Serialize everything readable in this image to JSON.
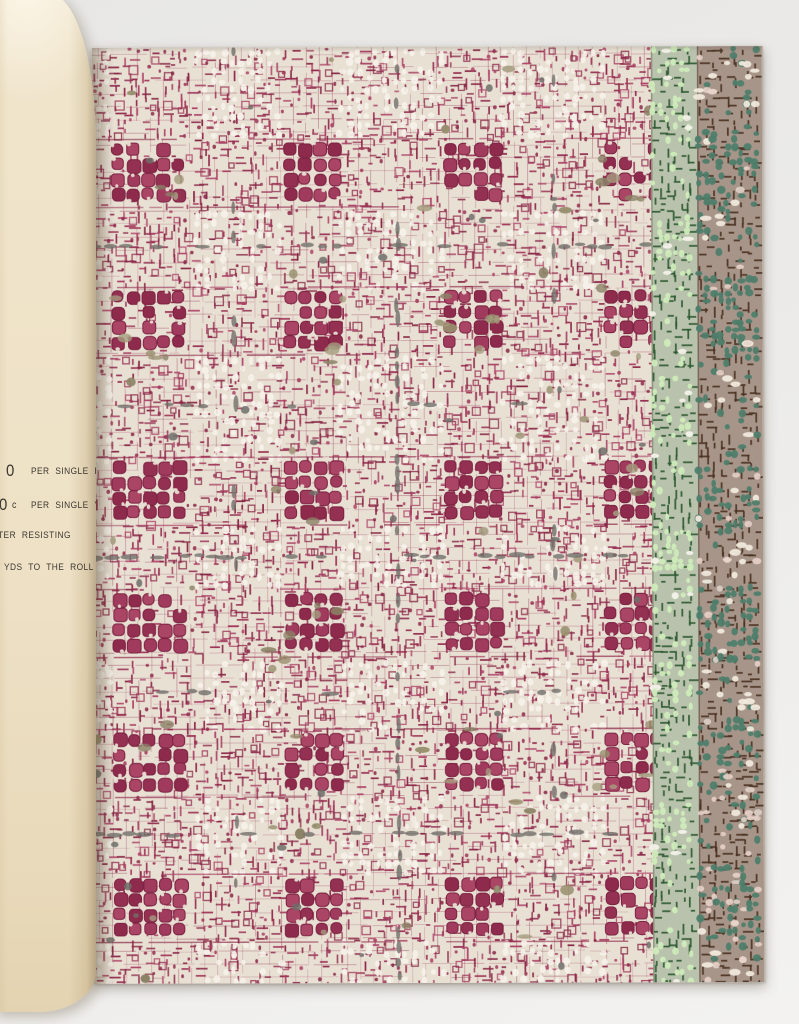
{
  "page_text": {
    "roll_price": "0",
    "roll_label": "PER SINGLE ROLL",
    "yard_price": "0",
    "yard_unit": "c",
    "yard_label": "PER SINGLE YARD",
    "feature_label": "TER RESISTING",
    "length_label": "YDS TO THE ROLL"
  },
  "pattern": {
    "seed": 7,
    "ground": "#e8e0d3",
    "white": "#f6f3ea",
    "maroon_shades": [
      "#93294d",
      "#a03558",
      "#872543",
      "#ad4166",
      "#8e2a4c"
    ],
    "block_shades": [
      "#a13b5e",
      "#943052",
      "#ab4566",
      "#8e2a4c"
    ],
    "block_stroke": "#7c2242",
    "olive_shades": [
      "#98906f",
      "#8b8266",
      "#a59d80"
    ],
    "gray": "#716f6a",
    "dark_gray_blob": "#6f6d68",
    "dense_cols": [
      {
        "c": 57,
        "hw": 40
      },
      {
        "c": 217,
        "hw": 28
      },
      {
        "c": 377,
        "hw": 28
      },
      {
        "c": 537,
        "hw": 28
      }
    ],
    "dense_row_centers": [
      125,
      273,
      443,
      575,
      715,
      860
    ],
    "row_halfwidth": 32,
    "gray_vertical": {
      "strong": [
        305
      ],
      "weak": [
        142,
        461
      ]
    },
    "gray_horizontal": {
      "strong": [
        199,
        509,
        787
      ],
      "medium": [
        358
      ],
      "weak": [
        645
      ]
    },
    "green_stripe": {
      "x": 559,
      "width": 46,
      "bg": "#b9c2ac",
      "dark": "#2e5a32",
      "mint": "#cfecba",
      "white": "#f3f1e9",
      "edge": "#5c6b50"
    },
    "taupe_stripe": {
      "x": 605,
      "width": 65,
      "bg": "#a8958a",
      "dark": "#4a3221",
      "teal": "#4e7d6b",
      "white": "#f0e9dc",
      "pink": "#e7d1c9",
      "edge": "#5a4436"
    }
  }
}
